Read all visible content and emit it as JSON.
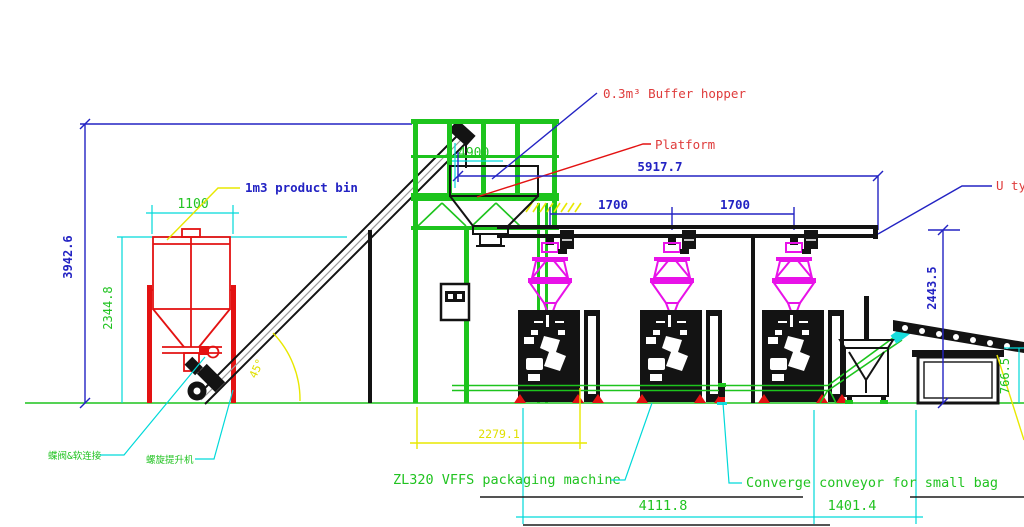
{
  "drawing": {
    "title_context": "Powder packing line side elevation",
    "labels": {
      "product_bin": "1m3 product bin",
      "buffer_hopper": "0.3m³ Buffer hopper",
      "platform": "Platform",
      "u_type_conveyor": "U ty",
      "vffs_machine": "ZL320 VFFS packaging machine",
      "converge_conveyor": "Converge conveyor for small bag",
      "butterfly_valve_cn": "蝶阀&软连接",
      "screw_elevator_cn": "螺旋提升机"
    },
    "dimensions": {
      "overall_height": "3942.6",
      "bin_height": "2344.8",
      "bin_width": "1100",
      "platform_height": "4900",
      "platform_length": "5917.7",
      "station_pitch_a": "1700",
      "station_pitch_b": "1700",
      "infeed_length": "2279.1",
      "line_length": "4111.8",
      "outfeed_length": "1401.4",
      "discharge_height": "2443.5",
      "stand_height": "766.5",
      "screw_angle": "45°"
    },
    "colors": {
      "dimension_blue": "#2323c3",
      "dimension_cyan": "#00d9d9",
      "dimension_yellow": "#e8e800",
      "equipment_green": "#1dc41d",
      "equipment_red": "#e31212",
      "weigher_magenta": "#e812e8",
      "machine_black": "#131313",
      "background": "#ffffff"
    }
  }
}
